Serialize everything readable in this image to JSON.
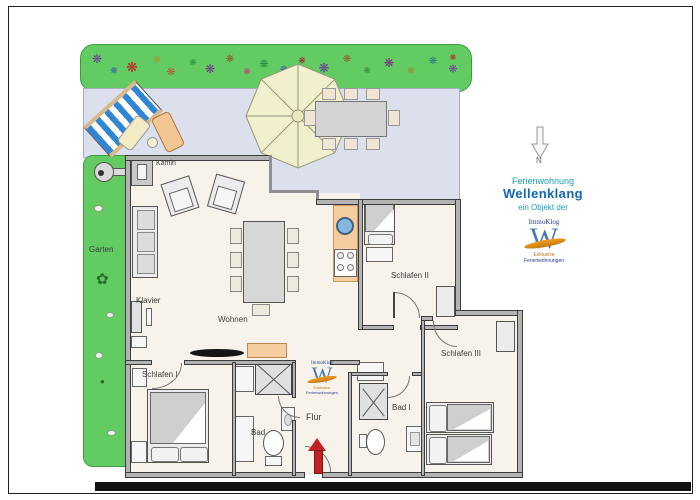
{
  "title": {
    "line1": "Ferienwohnung",
    "line2": "Wellenklang",
    "line3": "ein Objekt der"
  },
  "compass": {
    "label": "N"
  },
  "logo": {
    "brand": "ImmoKlog",
    "monogram": "W",
    "tagline1": "Exklusive",
    "tagline2": "Ferienwohnungen"
  },
  "outdoor": {
    "garden_label": "Garten"
  },
  "rooms": {
    "wohnen": "Wohnen",
    "kamin": "Kamin",
    "klavier": "Klavier",
    "flur": "Flur",
    "schlafen1": "Schlafen I",
    "schlafen2": "Schlafen II",
    "schlafen3": "Schlafen III",
    "bad": "Bad",
    "bad1": "Bad I"
  },
  "colors": {
    "garden": "#62cb62",
    "terrace": "#dbe0ec",
    "floor": "#f7f3ea",
    "kitchen": "#f5cda0",
    "wall": "#b3b3b3",
    "brand_blue": "#1266b8",
    "brand_teal": "#18a0b4",
    "arrow_red": "#c32222",
    "lounger_blue": "#2e86d4",
    "sink_blue": "#85b8dc",
    "logo_orange": "#f0a020",
    "logo_navy": "#27408b"
  }
}
